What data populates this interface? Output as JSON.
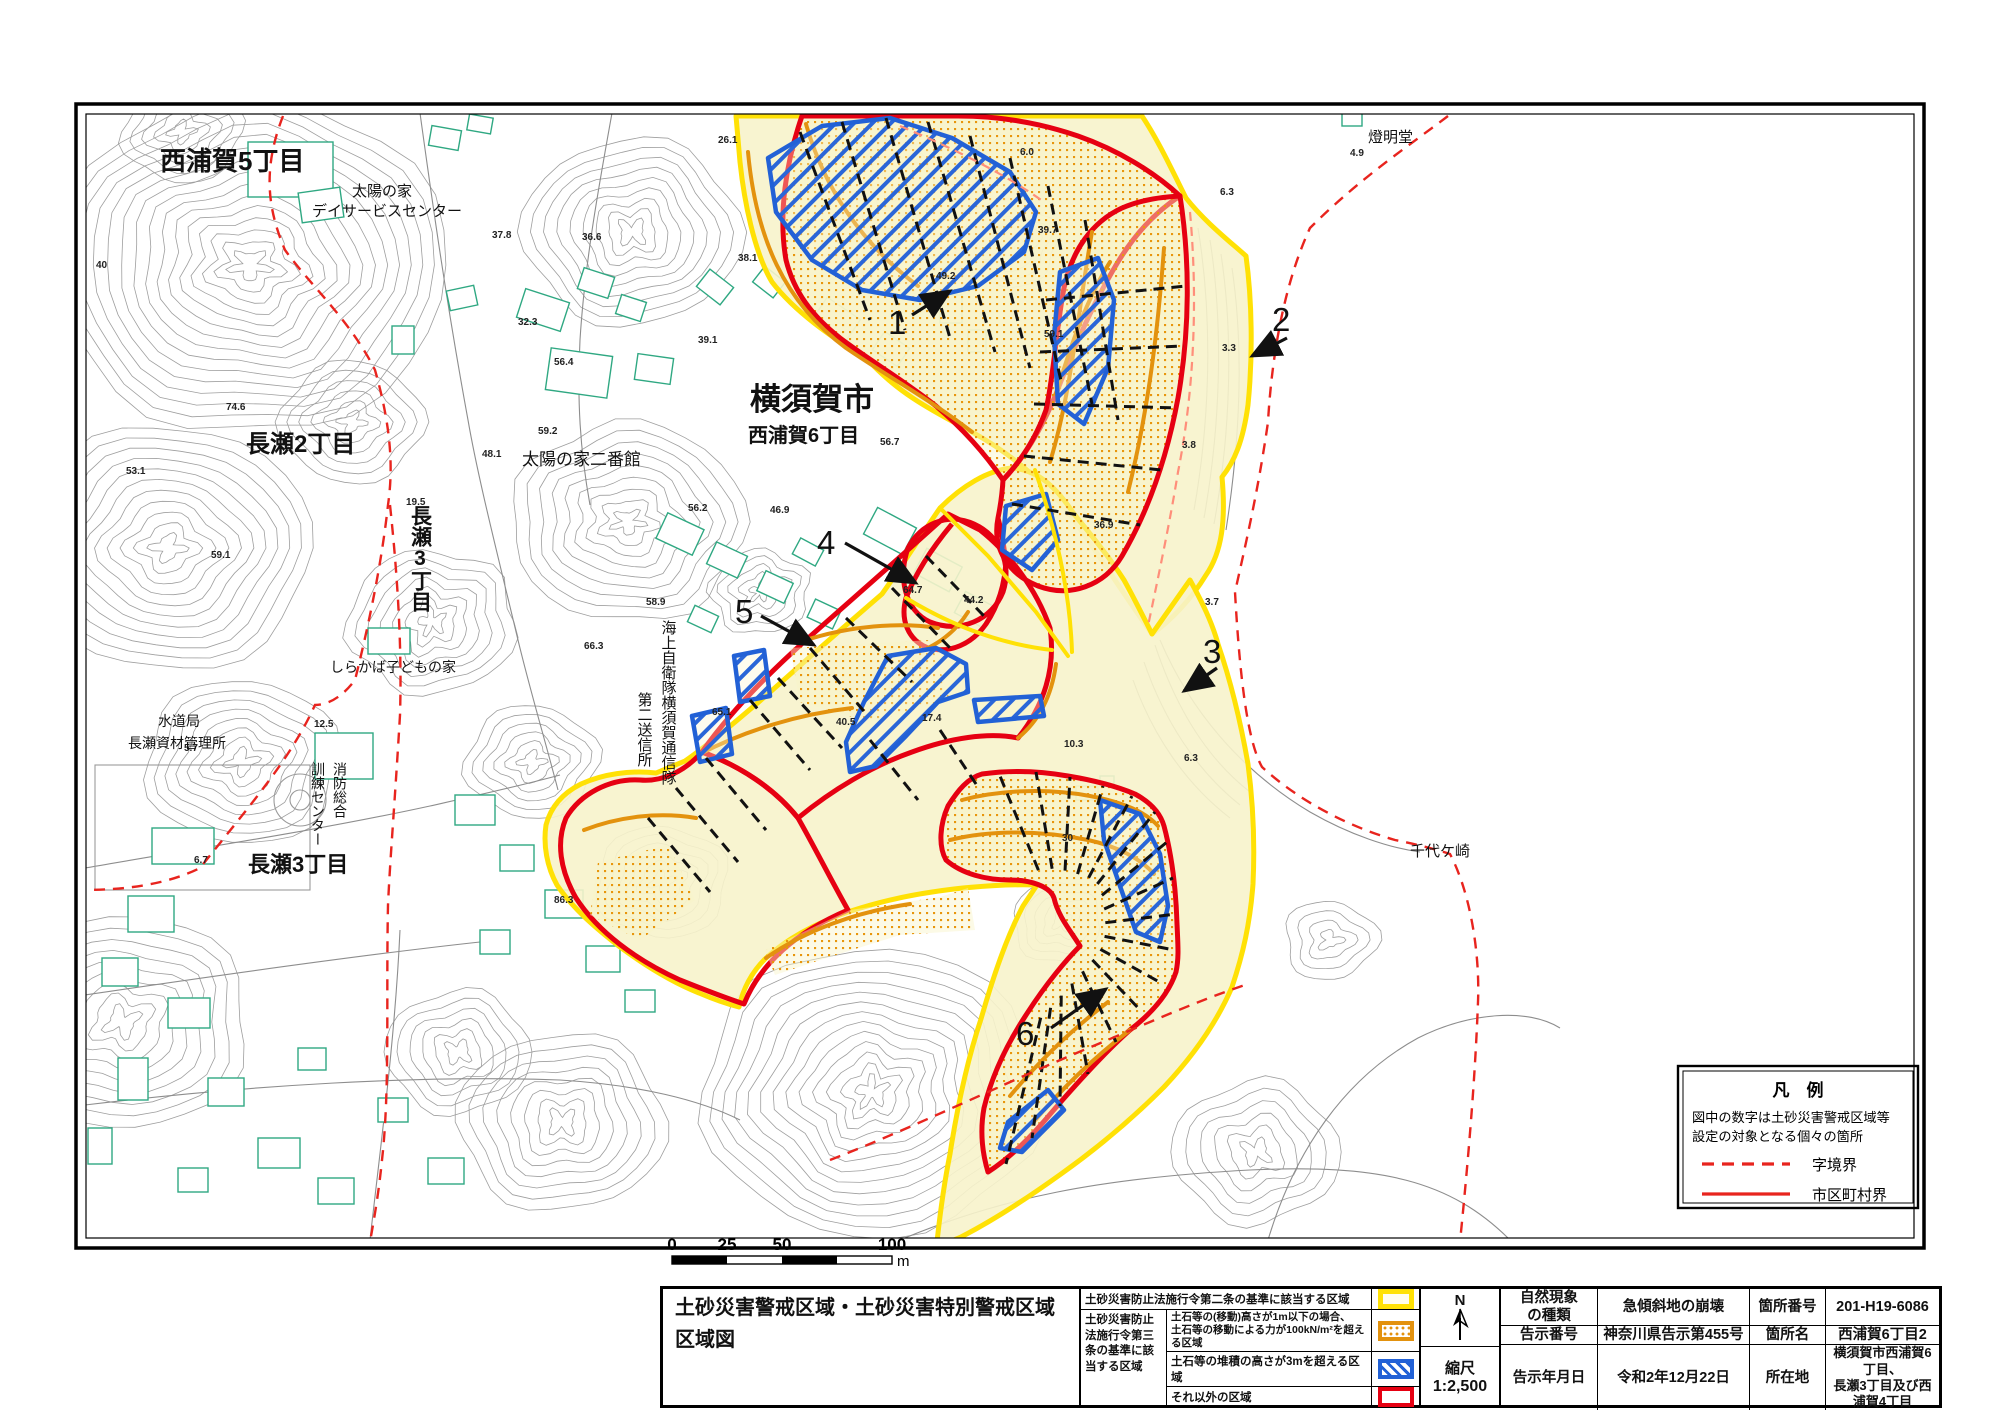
{
  "page_title": "土砂災害警戒区域等指定図(その2)(2／2)",
  "colors": {
    "warning_yellow": "#FFE105",
    "pale_yellow_fill": "#F7F3CB",
    "special_orange": "#E3920E",
    "special_blue": "#2261D6",
    "special_red": "#E60012",
    "boundary_red_dash": "#E8241E",
    "contour_gray": "#9E9E9E",
    "building_green": "#2FA882"
  },
  "map": {
    "place_labels": [
      {
        "t": "西浦賀5丁目",
        "x": 160,
        "y": 170,
        "s": 26,
        "b": 1
      },
      {
        "t": "太陽の家",
        "x": 352,
        "y": 196,
        "s": 15,
        "b": 0
      },
      {
        "t": "デイサービスセンター",
        "x": 312,
        "y": 216,
        "s": 15,
        "b": 0
      },
      {
        "t": "長瀬2丁目",
        "x": 246,
        "y": 452,
        "s": 24,
        "b": 1
      },
      {
        "t": "太陽の家二番館",
        "x": 522,
        "y": 465,
        "s": 17,
        "b": 0
      },
      {
        "t": "横須賀市",
        "x": 750,
        "y": 410,
        "s": 31,
        "b": 1
      },
      {
        "t": "西浦賀6丁目",
        "x": 748,
        "y": 442,
        "s": 20,
        "b": 1
      },
      {
        "t": "しらかば子どもの家",
        "x": 330,
        "y": 672,
        "s": 14,
        "b": 0
      },
      {
        "t": "水道局",
        "x": 158,
        "y": 726,
        "s": 14,
        "b": 0
      },
      {
        "t": "長瀬資材管理所",
        "x": 128,
        "y": 748,
        "s": 14,
        "b": 0
      },
      {
        "t": "長瀬3丁目",
        "x": 248,
        "y": 872,
        "s": 22,
        "b": 1
      },
      {
        "t": "燈明堂",
        "x": 1368,
        "y": 142,
        "s": 15,
        "b": 0
      },
      {
        "t": "千代ケ崎",
        "x": 1410,
        "y": 856,
        "s": 15,
        "b": 0
      }
    ],
    "vertical_labels": [
      {
        "t": "長瀬3丁目",
        "x": 420,
        "y": 505,
        "s": 21,
        "b": 1
      },
      {
        "t": "消防総合",
        "x": 340,
        "y": 762,
        "s": 14,
        "b": 0
      },
      {
        "t": "訓練センター",
        "x": 318,
        "y": 762,
        "s": 14,
        "b": 0
      },
      {
        "t": "海上自衛隊横須賀通信隊",
        "x": 668,
        "y": 620,
        "s": 15,
        "b": 0
      },
      {
        "t": "第二送信所",
        "x": 644,
        "y": 692,
        "s": 15,
        "b": 0
      }
    ],
    "spot_elevations": [
      {
        "v": "40",
        "x": 96,
        "y": 268
      },
      {
        "v": "74.6",
        "x": 226,
        "y": 410
      },
      {
        "v": "53.1",
        "x": 126,
        "y": 474
      },
      {
        "v": "59.1",
        "x": 211,
        "y": 558
      },
      {
        "v": "19.5",
        "x": 406,
        "y": 505
      },
      {
        "v": "37.8",
        "x": 492,
        "y": 238
      },
      {
        "v": "36.6",
        "x": 582,
        "y": 240
      },
      {
        "v": "32.3",
        "x": 518,
        "y": 325
      },
      {
        "v": "56.4",
        "x": 554,
        "y": 365
      },
      {
        "v": "59.2",
        "x": 538,
        "y": 434
      },
      {
        "v": "48.1",
        "x": 482,
        "y": 457
      },
      {
        "v": "39.1",
        "x": 698,
        "y": 343
      },
      {
        "v": "38.1",
        "x": 738,
        "y": 261
      },
      {
        "v": "49.2",
        "x": 936,
        "y": 279
      },
      {
        "v": "26.1",
        "x": 718,
        "y": 143
      },
      {
        "v": "56.7",
        "x": 880,
        "y": 445
      },
      {
        "v": "59.1",
        "x": 1044,
        "y": 337
      },
      {
        "v": "39.7",
        "x": 1038,
        "y": 233
      },
      {
        "v": "6.0",
        "x": 1020,
        "y": 155
      },
      {
        "v": "4.9",
        "x": 1350,
        "y": 156
      },
      {
        "v": "6.3",
        "x": 1220,
        "y": 195
      },
      {
        "v": "3.8",
        "x": 1182,
        "y": 448
      },
      {
        "v": "3.3",
        "x": 1222,
        "y": 351
      },
      {
        "v": "3.7",
        "x": 1205,
        "y": 605
      },
      {
        "v": "6.3",
        "x": 1184,
        "y": 761
      },
      {
        "v": "56.2",
        "x": 688,
        "y": 511
      },
      {
        "v": "46.9",
        "x": 770,
        "y": 513
      },
      {
        "v": "58.9",
        "x": 646,
        "y": 605
      },
      {
        "v": "64.7",
        "x": 903,
        "y": 593
      },
      {
        "v": "44.2",
        "x": 964,
        "y": 603
      },
      {
        "v": "65.1",
        "x": 712,
        "y": 715
      },
      {
        "v": "40.5",
        "x": 836,
        "y": 725
      },
      {
        "v": "17.4",
        "x": 922,
        "y": 721
      },
      {
        "v": "10.3",
        "x": 1064,
        "y": 747
      },
      {
        "v": "36.9",
        "x": 1094,
        "y": 528
      },
      {
        "v": "30",
        "x": 1062,
        "y": 841
      },
      {
        "v": "12.5",
        "x": 314,
        "y": 727
      },
      {
        "v": "5.7",
        "x": 184,
        "y": 751
      },
      {
        "v": "6.7",
        "x": 194,
        "y": 863
      },
      {
        "v": "66.3",
        "x": 584,
        "y": 649
      },
      {
        "v": "86.3",
        "x": 554,
        "y": 903
      }
    ],
    "site_numbers": [
      {
        "n": "1",
        "tx": 888,
        "ty": 334,
        "ax": 912,
        "ay": 315,
        "bx": 950,
        "by": 291
      },
      {
        "n": "2",
        "tx": 1272,
        "ty": 331,
        "ax": 1287,
        "ay": 338,
        "bx": 1252,
        "by": 356
      },
      {
        "n": "3",
        "tx": 1203,
        "ty": 663,
        "ax": 1217,
        "ay": 668,
        "bx": 1184,
        "by": 691
      },
      {
        "n": "4",
        "tx": 817,
        "ty": 554,
        "ax": 845,
        "ay": 543,
        "bx": 916,
        "by": 583
      },
      {
        "n": "5",
        "tx": 735,
        "ty": 623,
        "ax": 761,
        "ay": 616,
        "bx": 814,
        "by": 645
      },
      {
        "n": "6",
        "tx": 1016,
        "ty": 1045,
        "ax": 1051,
        "ay": 1028,
        "bx": 1106,
        "by": 989
      }
    ],
    "legend_box": {
      "title": "凡　例",
      "note_line1": "図中の数字は土砂災害警戒区域等",
      "note_line2": "設定の対象となる個々の箇所",
      "dashed_label": "字境界",
      "solid_label": "市区町村界"
    },
    "scale_bar": {
      "labels": [
        "0",
        "25",
        "50",
        "100"
      ],
      "unit": "m"
    }
  },
  "info_table": {
    "sheet_title_line1": "土砂災害警戒区域・土砂災害特別警戒区域",
    "sheet_title_line2": "区域図",
    "article2_label": "土砂災害防止法施行令第二条の基準に該当する区域",
    "article3_group_label": "土砂災害防止法施行令第三条の基準に該当する区域",
    "article3_row1_line1": "土石等の(移動)高さが1m以下の場合、",
    "article3_row1_line2": "土石等の移動による力が100kN/m²を超える区域",
    "article3_row2": "土石等の堆積の高さが3mを超える区域",
    "article3_row3": "それ以外の区域",
    "compass_letter": "N",
    "scale_label": "縮尺",
    "scale_value": "1:2,500",
    "rows": [
      {
        "h1": "自然現象\nの種類",
        "v1": "急傾斜地の崩壊",
        "h2": "箇所番号",
        "v2": "201-H19-6086"
      },
      {
        "h1": "告示番号",
        "v1": "神奈川県告示第455号",
        "h2": "箇所名",
        "v2": "西浦賀6丁目2"
      },
      {
        "h1": "告示年月日",
        "v1": "令和2年12月22日",
        "h2": "所在地",
        "v2": "横須賀市西浦賀6丁目、\n長瀬3丁目及び西浦賀4丁目"
      }
    ]
  }
}
